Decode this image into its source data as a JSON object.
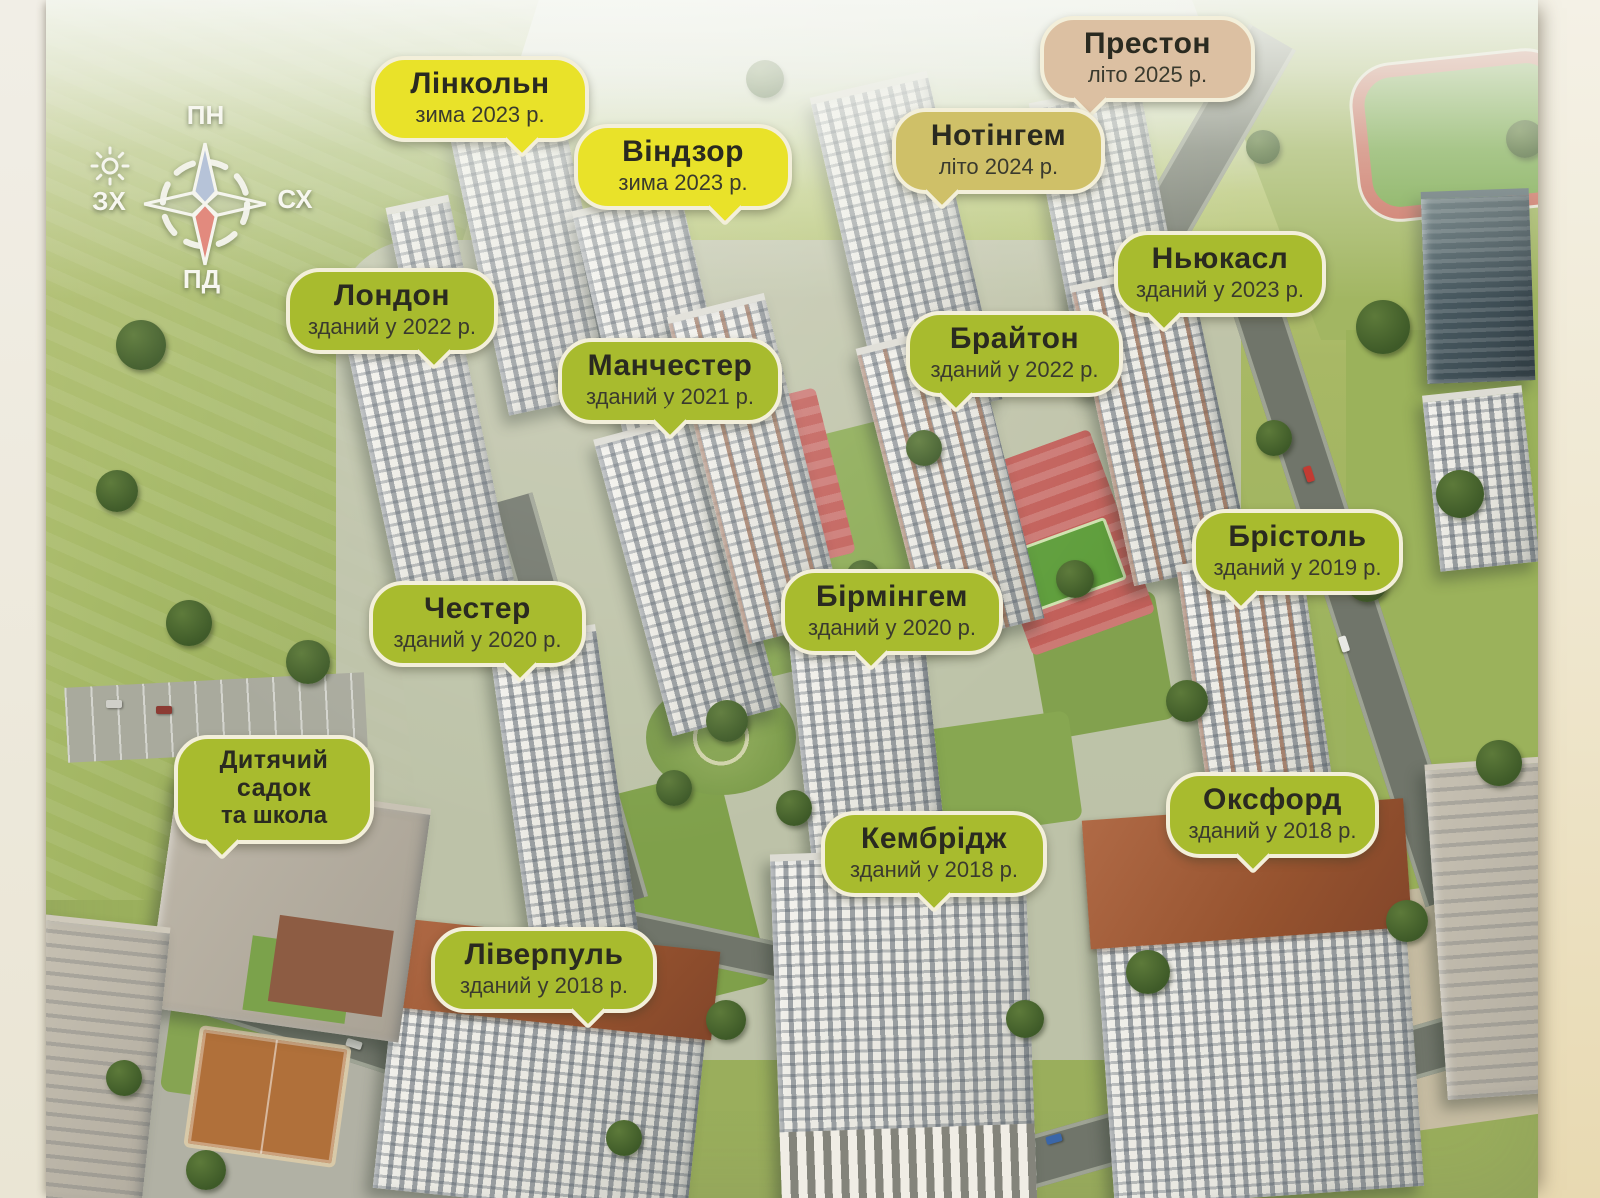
{
  "palette": {
    "green_bubble": "#a8bb2e",
    "yellow_bubble": "#e9e229",
    "olive_bubble": "#cfc068",
    "tan_bubble": "#dcc0a2",
    "bubble_border": "#f3efda",
    "bubble_text": "#2a2a20"
  },
  "compass": {
    "north": "ПН",
    "east": "СХ",
    "south": "ПД",
    "west": "ЗХ"
  },
  "labels": [
    {
      "id": "linkoln",
      "title": "Лінкольн",
      "subtitle": "зима 2023 р.",
      "color": "yellow"
    },
    {
      "id": "vindzor",
      "title": "Віндзор",
      "subtitle": "зима 2023 р.",
      "color": "yellow"
    },
    {
      "id": "preston",
      "title": "Престон",
      "subtitle": "літо 2025 р.",
      "color": "tan"
    },
    {
      "id": "notingem",
      "title": "Нотінгем",
      "subtitle": "літо 2024 р.",
      "color": "olive"
    },
    {
      "id": "niukasl",
      "title": "Ньюкасл",
      "subtitle": "зданий у 2023 р.",
      "color": "green"
    },
    {
      "id": "london",
      "title": "Лондон",
      "subtitle": "зданий у 2022 р.",
      "color": "green"
    },
    {
      "id": "manchester",
      "title": "Манчестер",
      "subtitle": "зданий у 2021 р.",
      "color": "green"
    },
    {
      "id": "braiton",
      "title": "Брайтон",
      "subtitle": "зданий у 2022 р.",
      "color": "green"
    },
    {
      "id": "bristol",
      "title": "Брістоль",
      "subtitle": "зданий у 2019 р.",
      "color": "green"
    },
    {
      "id": "chester",
      "title": "Честер",
      "subtitle": "зданий у 2020 р.",
      "color": "green"
    },
    {
      "id": "birmingem",
      "title": "Бірмінгем",
      "subtitle": "зданий у 2020 р.",
      "color": "green"
    },
    {
      "id": "sadok",
      "title": "Дитячий садок",
      "subtitle": "та школа",
      "color": "green"
    },
    {
      "id": "oksford",
      "title": "Оксфорд",
      "subtitle": "зданий у 2018 р.",
      "color": "green"
    },
    {
      "id": "kembridzh",
      "title": "Кембрідж",
      "subtitle": "зданий у 2018 р.",
      "color": "green"
    },
    {
      "id": "liverpul",
      "title": "Ліверпуль",
      "subtitle": "зданий у 2018 р.",
      "color": "green"
    }
  ]
}
